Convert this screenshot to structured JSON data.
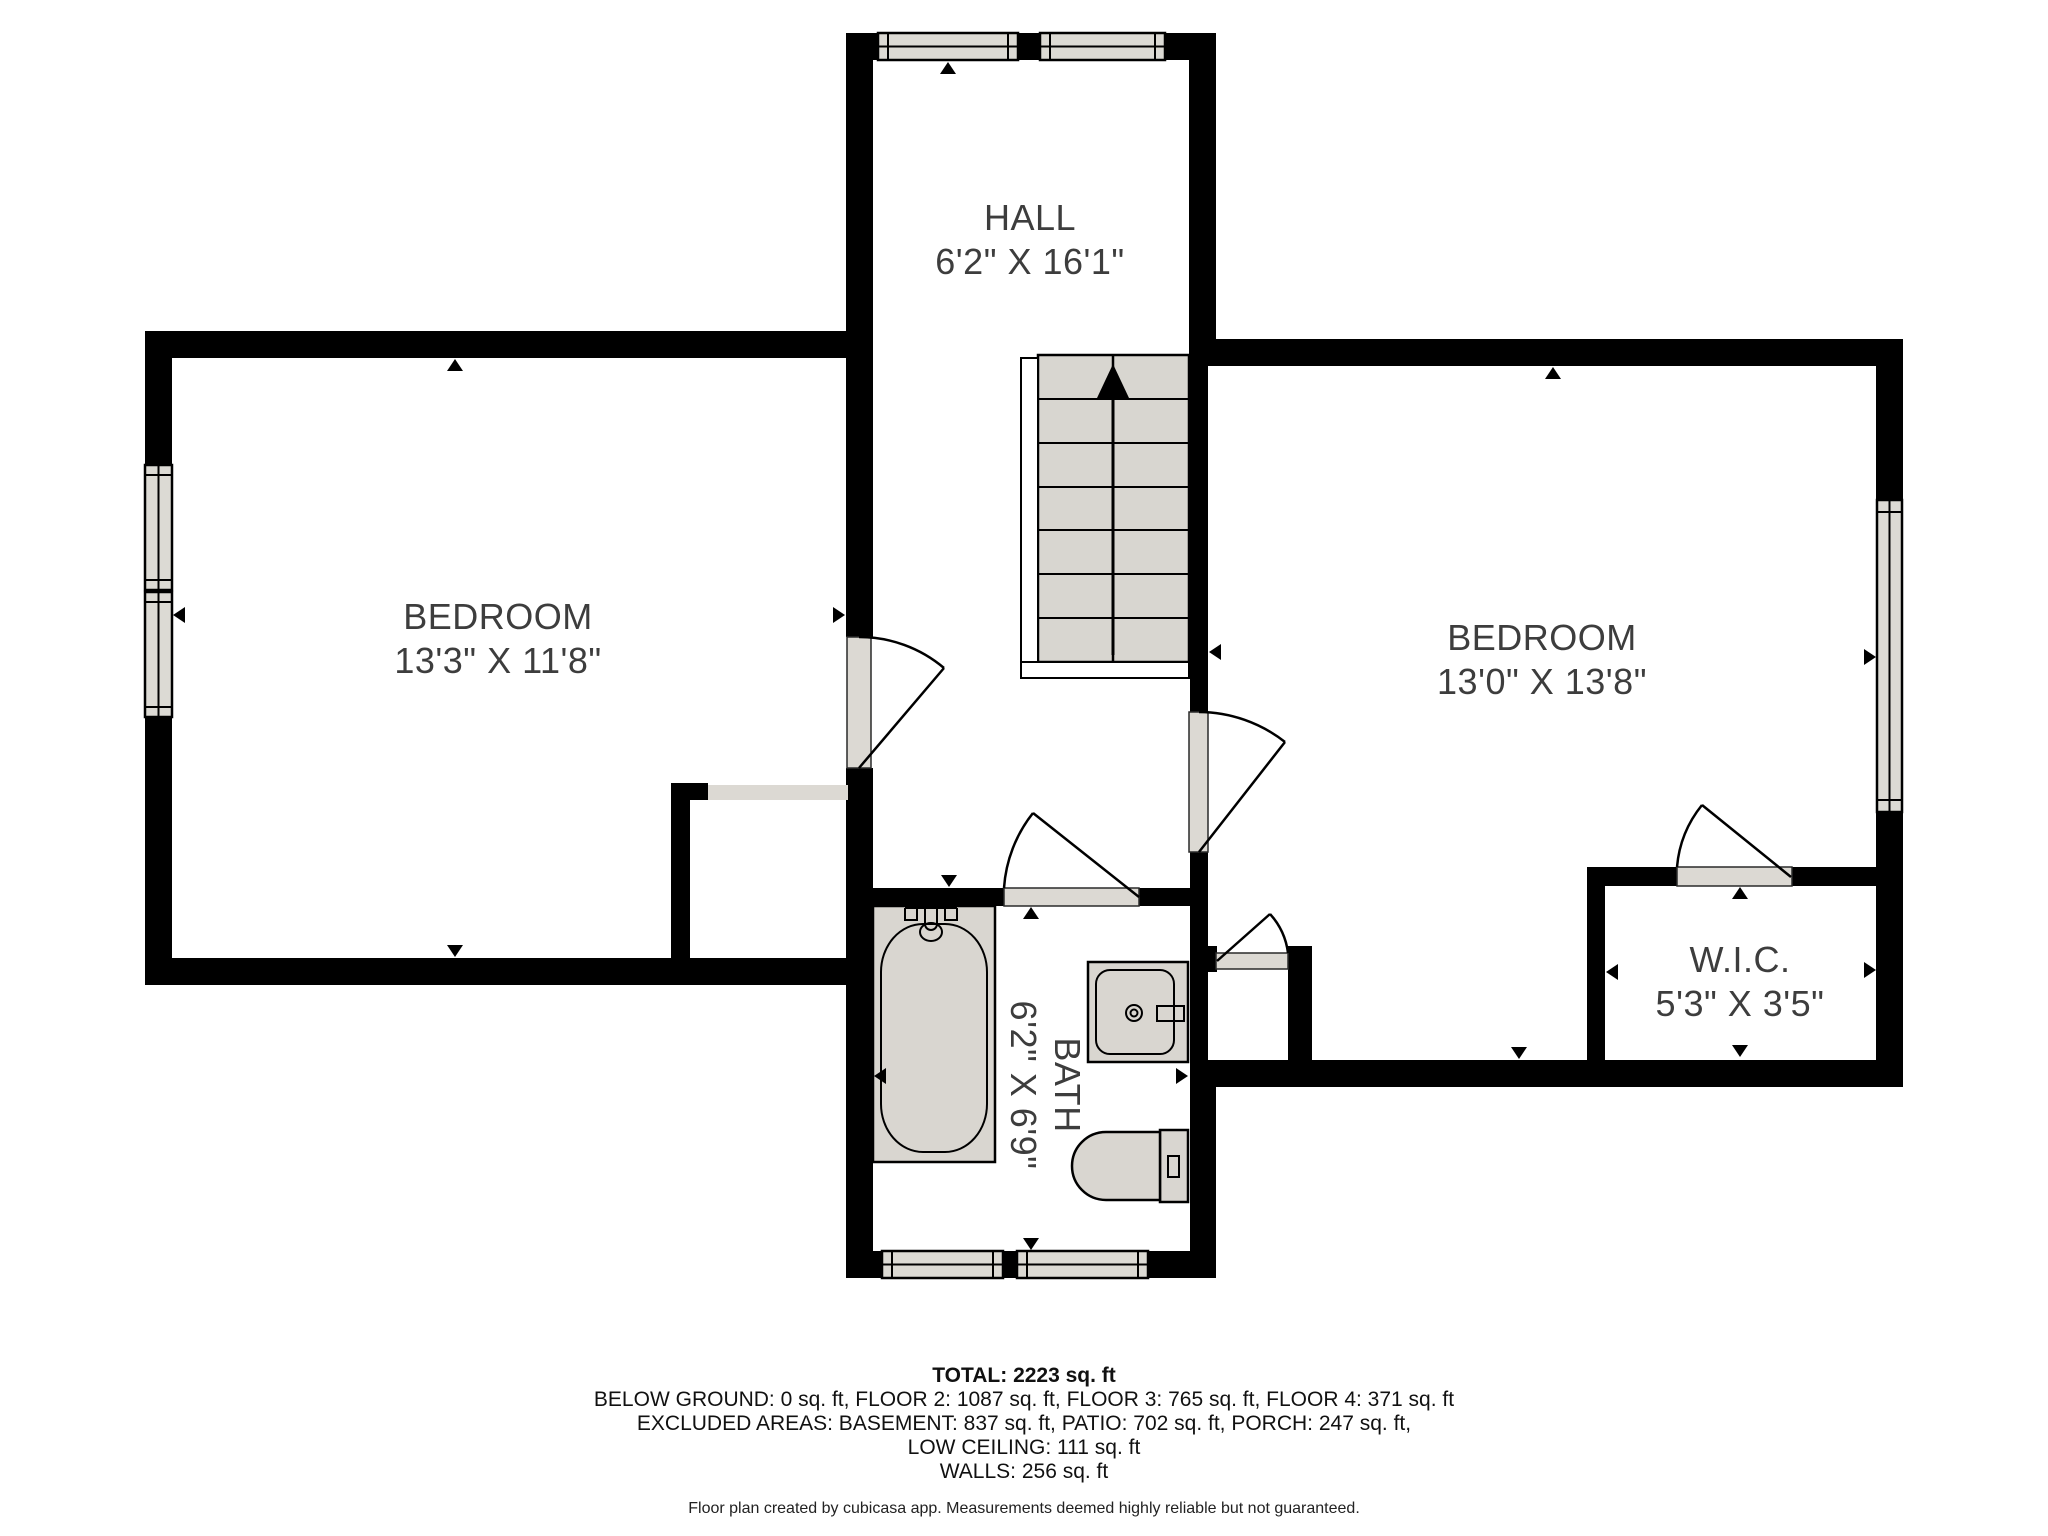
{
  "floorplan": {
    "rooms": [
      {
        "id": "hall",
        "name": "HALL",
        "dims": "6'2\" X 16'1\""
      },
      {
        "id": "bedroom-left",
        "name": "BEDROOM",
        "dims": "13'3\" X 11'8\""
      },
      {
        "id": "bedroom-right",
        "name": "BEDROOM",
        "dims": "13'0\" X 13'8\""
      },
      {
        "id": "bath",
        "name": "BATH",
        "dims": "6'2\" X 6'9\""
      },
      {
        "id": "wic",
        "name": "W.I.C.",
        "dims": "5'3\" X 3'5\""
      }
    ],
    "stairs_direction": "up"
  },
  "summary": {
    "total": "TOTAL: 2223 sq. ft",
    "lines": [
      "BELOW GROUND: 0 sq. ft, FLOOR 2: 1087 sq. ft, FLOOR 3: 765 sq. ft, FLOOR 4: 371 sq. ft",
      "EXCLUDED AREAS: BASEMENT: 837 sq. ft, PATIO: 702 sq. ft, PORCH: 247 sq. ft,",
      "LOW CEILING: 111 sq. ft",
      "WALLS: 256 sq. ft"
    ],
    "disclaimer": "Floor plan created by cubicasa app. Measurements deemed highly reliable but not guaranteed."
  },
  "colors": {
    "wall": "#000000",
    "fixture_fill": "#d9d6d0",
    "window_fill": "#dcdad4",
    "text": "#3d3d3d",
    "background": "#ffffff"
  }
}
